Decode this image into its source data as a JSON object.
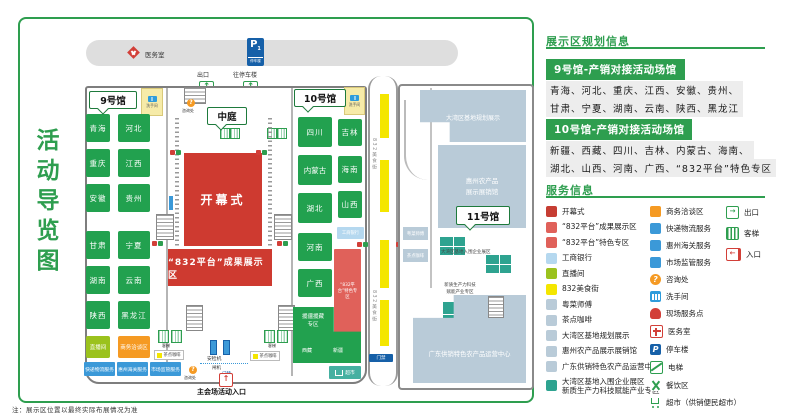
{
  "note": "注：展示区位置以最终实际布展情况为准",
  "map": {
    "title": "活动导览图",
    "top": {
      "medical": "医务室",
      "parking_letter": "P",
      "parking_level": "1",
      "parking_name": "停车楼",
      "exit": "出口",
      "to_parking": "往停车楼"
    },
    "tags": {
      "hall9": "9号馆",
      "hall10": "10号馆",
      "hall11": "11号馆",
      "atrium": "中庭"
    },
    "labels": {
      "restroom": "洗手间",
      "info_desk": "咨询处",
      "elevator": "客梯",
      "security_machine": "安检机",
      "turnstile": "闸机",
      "access_gate": "门禁",
      "main_entrance": "主会场活动入口",
      "tea_coffee": "茶点咖啡"
    },
    "hall9": {
      "provinces": [
        "青海",
        "河北",
        "重庆",
        "江西",
        "安徽",
        "贵州",
        "甘肃",
        "宁夏",
        "湖南",
        "云南",
        "陕西",
        "黑龙江"
      ],
      "live_room": "直播间",
      "business_area": "商务洽谈区",
      "services": [
        "快递物流服务",
        "惠州海关服务",
        "市场监管服务"
      ]
    },
    "central": {
      "opening": "开幕式",
      "achievement_zone": "“832平台”成果展示区"
    },
    "hall10": {
      "provinces": [
        "四川",
        "吉林",
        "内蒙古",
        "海南",
        "湖北",
        "山西",
        "河南",
        "广西"
      ],
      "special_zone": "“832平台”特色专区",
      "aid_zone": "援疆援藏专区",
      "tibet": "西藏",
      "xinjiang": "新疆",
      "icbc": "工商银行",
      "supermarket": "超市"
    },
    "road": {
      "name": "832美食街",
      "gate": "门禁"
    },
    "hall11": {
      "planning": "大湾区基地规划展示",
      "huizhou_hall": "惠州农产品展示展销馆",
      "enterprise_zone": "大湾区基地入围企业展区",
      "tech_zone": "新质生产力科技赋能产业专区",
      "gd_center": "广东供销特色农产品运营中心",
      "chef": "粤菜师傅",
      "tea": "茶点咖啡"
    }
  },
  "panel": {
    "planning_title": "展示区规划信息",
    "hall9_header": "9号馆-产销对接活动场馆",
    "hall9_line1": "青海、河北、重庆、江西、安徽、贵州、",
    "hall9_line2": "甘肃、宁夏、湖南、云南、陕西、黑龙江",
    "hall10_header": "10号馆-产销对接活动场馆",
    "hall10_line1": "新疆、西藏、四川、吉林、内蒙古、海南、",
    "hall10_line2": "湖北、山西、河南、广西、“832平台”特色专区",
    "service_title": "服务信息",
    "legend1": [
      {
        "label": "开幕式",
        "icon": "red-swatch",
        "color": "#c63d33"
      },
      {
        "label": "“832平台”成果展示区",
        "icon": "light-red-swatch",
        "color": "#e0615a"
      },
      {
        "label": "“832平台”特色专区",
        "icon": "light-red-swatch",
        "color": "#e0615a"
      },
      {
        "label": "工商银行",
        "icon": "light-blue-swatch",
        "color": "#b5d8ef"
      },
      {
        "label": "直播间",
        "icon": "yellow-green-swatch",
        "color": "#9bc21d"
      },
      {
        "label": "832美食街",
        "icon": "yellow-swatch",
        "color": "#f4e600"
      },
      {
        "label": "粤菜师傅",
        "icon": "gray-blue-swatch",
        "color": "#b9cbd8"
      },
      {
        "label": "茶点咖啡",
        "icon": "gray-blue-swatch",
        "color": "#b9cbd8"
      },
      {
        "label": "大湾区基地规划展示",
        "icon": "gray-blue-swatch",
        "color": "#b9cbd8"
      },
      {
        "label": "惠州农产品展示展销馆",
        "icon": "gray-blue-swatch",
        "color": "#b9cbd8"
      },
      {
        "label": "广东供销特色农产品运营中心",
        "icon": "gray-blue-swatch",
        "color": "#b9cbd8"
      },
      {
        "label": "大湾区基地入围企业展区",
        "label2": "新质生产力科技赋能产业专区",
        "icon": "teal-swatch",
        "color": "#2ea390"
      }
    ],
    "legend2": [
      {
        "label": "商务洽谈区",
        "icon": "orange-swatch",
        "color": "#f59a23"
      },
      {
        "label": "快递物流服务",
        "icon": "blue-swatch",
        "color": "#3b99d8"
      },
      {
        "label": "惠州海关服务",
        "icon": "blue-swatch",
        "color": "#3b99d8"
      },
      {
        "label": "市场监管服务",
        "icon": "blue-swatch",
        "color": "#3b99d8"
      },
      {
        "label": "咨询处",
        "icon": "info-icon"
      },
      {
        "label": "洗手间",
        "icon": "restroom-icon"
      },
      {
        "label": "现场服务点",
        "icon": "service-point-icon"
      },
      {
        "label": "医务室",
        "icon": "medical-icon"
      },
      {
        "label": "停车楼",
        "icon": "parking-icon"
      },
      {
        "label": "电梯",
        "icon": "escalator-icon"
      },
      {
        "label": "餐饮区",
        "icon": "dining-icon"
      },
      {
        "label": "超市（供销便民超市）",
        "icon": "cart-icon"
      }
    ],
    "legend3": [
      {
        "label": "出口",
        "icon": "exit-icon"
      },
      {
        "label": "客梯",
        "icon": "elevator-icon"
      },
      {
        "label": "入口",
        "icon": "entrance-icon"
      }
    ]
  },
  "colors": {
    "brand_green": "#2e9e4f",
    "province_green": "#22a14f",
    "red": "#ce3a30",
    "light_red": "#e0615a",
    "orange": "#f59a23",
    "blue": "#3b99d8",
    "light_blue": "#b5d8ef",
    "gray_blue": "#b9cbd8",
    "teal": "#2ea390",
    "yellow": "#f4e600",
    "yellow_green": "#9bc21d",
    "parking_blue": "#1660a8"
  }
}
